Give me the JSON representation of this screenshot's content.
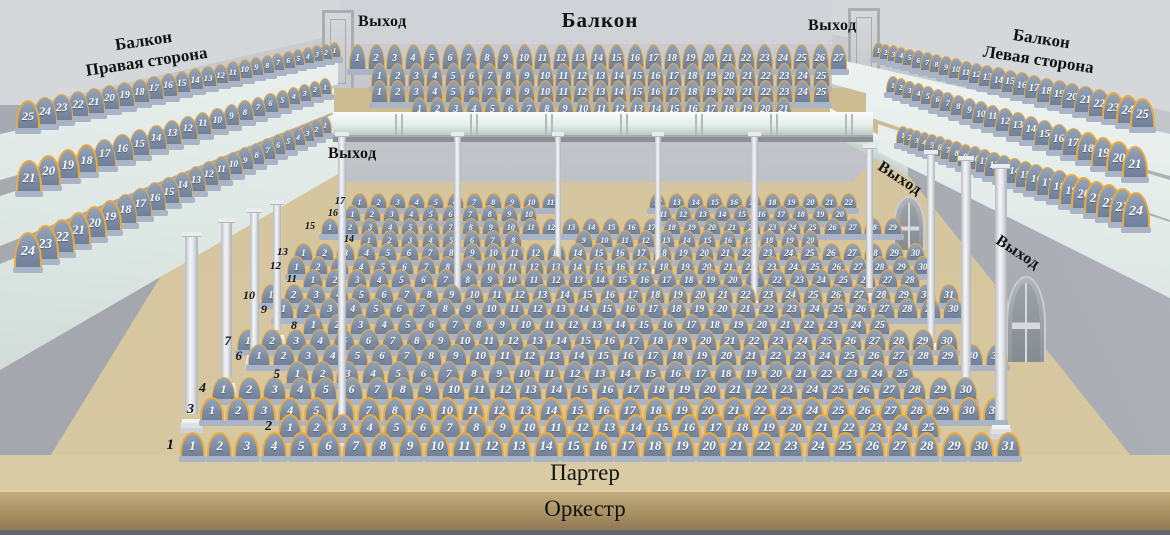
{
  "labels": {
    "balcony_center": "Балкон",
    "exit": "Выход",
    "parterre": "Партер",
    "orchestra": "Оркестр"
  },
  "balcony_right_side": {
    "line1": "Балкон",
    "line2": "Правая сторона",
    "rows": [
      {
        "start": 25,
        "end": 1
      },
      {
        "start": 21,
        "end": 1
      },
      {
        "start": 24,
        "end": 1
      }
    ]
  },
  "balcony_left_side": {
    "line1": "Балкон",
    "line2": "Левая сторона",
    "rows": [
      {
        "start": 1,
        "end": 25
      },
      {
        "start": 1,
        "end": 21
      },
      {
        "start": 1,
        "end": 24
      }
    ]
  },
  "balcony_center_rows": [
    {
      "start": 1,
      "end": 27
    },
    {
      "start": 1,
      "end": 25
    },
    {
      "start": 1,
      "end": 25
    },
    {
      "start": 1,
      "end": 21
    }
  ],
  "parterre": {
    "rows": [
      {
        "label": "1",
        "start": 1,
        "end": 31
      },
      {
        "label": "2",
        "start": 1,
        "end": 25
      },
      {
        "label": "3",
        "start": 1,
        "end": 31
      },
      {
        "label": "4",
        "start": 1,
        "end": 30
      },
      {
        "label": "5",
        "start": 1,
        "end": 25
      },
      {
        "label": "6",
        "start": 1,
        "end": 31
      },
      {
        "label": "7",
        "start": 1,
        "end": 30
      },
      {
        "label": "8",
        "start": 1,
        "end": 25
      },
      {
        "label": "9",
        "start": 1,
        "end": 30
      },
      {
        "label": "10",
        "start": 1,
        "end": 31
      },
      {
        "label": "11",
        "start": 1,
        "end": 28
      },
      {
        "label": "12",
        "start": 1,
        "end": 30
      },
      {
        "label": "13",
        "start": 1,
        "end": 30
      },
      {
        "label": "14",
        "start": 1,
        "end": 20,
        "gap_after": 8
      },
      {
        "label": "15",
        "start": 1,
        "end": 29
      },
      {
        "label": "16",
        "start": 1,
        "end": 20,
        "gap_after": 10
      },
      {
        "label": "17",
        "start": 1,
        "end": 22,
        "gap_after": 11
      }
    ]
  },
  "colors": {
    "seat_fill": "#7b8ca4",
    "seat_border": "#edaa3c",
    "seat_base": "#a9b5c6",
    "seat_number": "#ffffff",
    "floor": "#d5c69f",
    "orchestra": "#9c855c",
    "wall": "#b4b8bd",
    "balcony_board": "#e4ebe8",
    "column": "#eef0f3",
    "label_text": "#121212"
  }
}
